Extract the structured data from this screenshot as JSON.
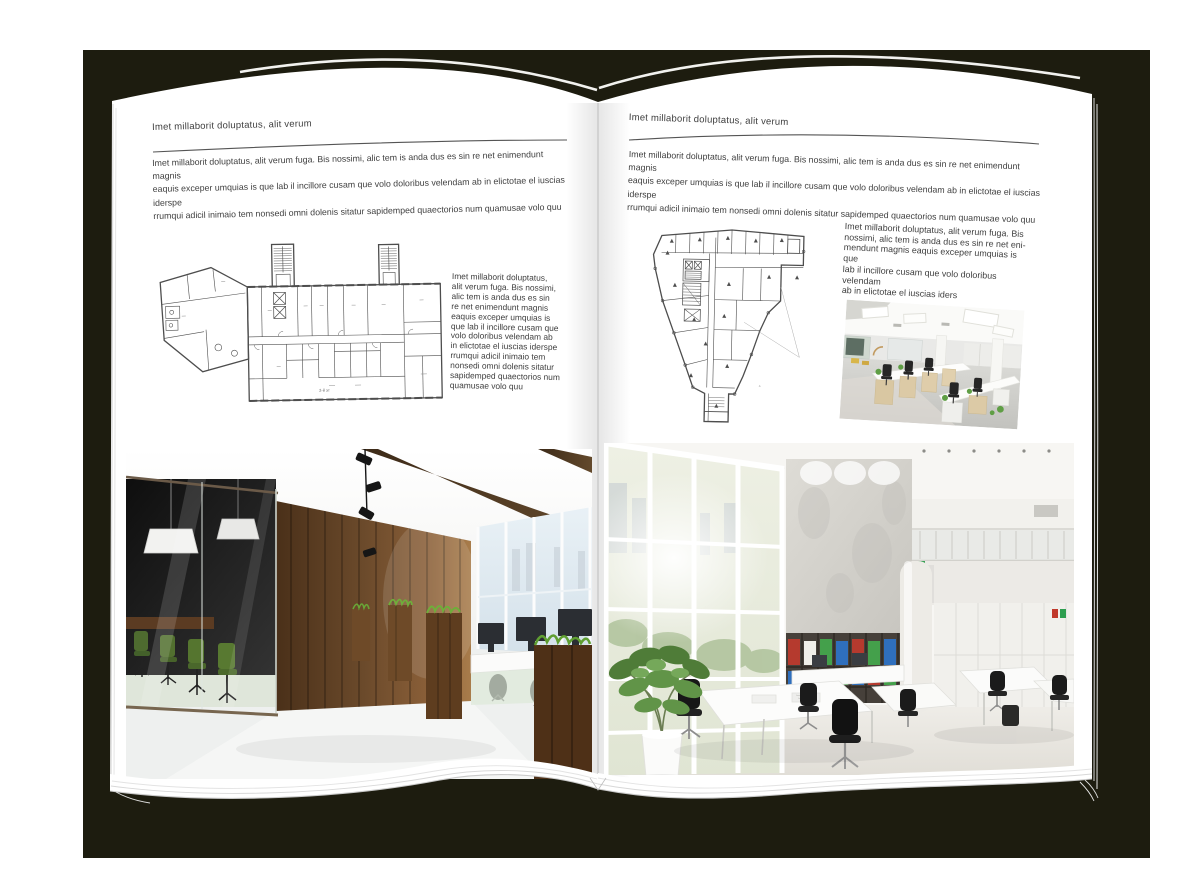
{
  "backdrop": {
    "color": "#1d1c0f",
    "canvas_color": "#ffffff",
    "page_color": "#ffffff"
  },
  "left_page": {
    "header": "Imet millaborit doluptatus, alit verum",
    "intro": "Imet millaborit doluptatus, alit verum fuga. Bis nossimi, alic tem is anda dus es sin re net enimendunt magnis\neaquis exceper umquias is que lab il incillore cusam que volo doloribus velendam ab in elictotae el iuscias iderspe\nrrumqui adicil inimaio tem nonsedi omni dolenis sitatur sapidemped quaectorios num quamusae volo quu",
    "side_text": "Imet millaborit doluptatus,\nalit verum fuga. Bis nossimi,\nalic tem is anda dus es sin\nre net enimendunt magnis\neaquis exceper umquias is\nque lab il incillore cusam que\nvolo doloribus velendam ab\nin elictotae el iuscias iderspe\nrrumqui adicil inimaio tem\nnonsedi omni dolenis sitatur\nsapidemped quaectorios num\nquamusae volo quu"
  },
  "right_page": {
    "header": "Imet millaborit doluptatus, alit verum",
    "intro": "Imet millaborit doluptatus, alit verum fuga. Bis nossimi, alic tem is anda dus es sin re net enimendunt magnis\neaquis exceper umquias is que lab il incillore cusam que volo doloribus velendam ab in elictotae el iuscias iderspe\nrrumqui adicil inimaio tem nonsedi omni dolenis sitatur sapidemped quaectorios num quamusae volo quu",
    "side_text": "Imet millaborit doluptatus, alit verum fuga. Bis\nnossimi, alic tem is anda dus es sin re net eni-\nmendunt magnis eaquis exceper umquias is que\nlab il incillore cusam que volo doloribus velendam\nab in elictotae el iuscias iders"
  }
}
